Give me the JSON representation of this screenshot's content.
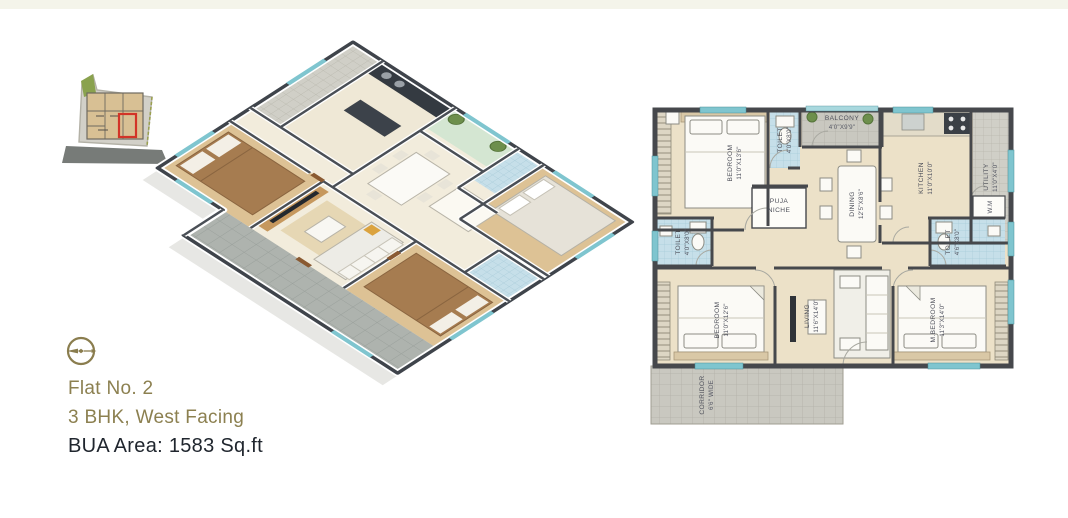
{
  "page": {
    "top_strip_color": "#f4f4ea",
    "background": "#ffffff"
  },
  "project": {
    "flat_no": "Flat No. 2",
    "configuration": "3 BHK, West Facing",
    "bua": "BUA Area: 1583 Sq.ft"
  },
  "colors": {
    "accent_olive": "#8c8050",
    "text_dark": "#20262e",
    "wall": "#46484c",
    "floor_beige": "#ece1c8",
    "tile_blue": "#c6dfe9",
    "tile_gray": "#c9c8c0",
    "wood": "#ddc295",
    "bed_brown": "#a67c50",
    "window_teal": "#7fc5cf",
    "site_highlight_red": "#d23428"
  },
  "plan2d": {
    "labels": [
      {
        "id": "bedroom-1",
        "line1": "BEDROOM",
        "line2": "11'0\"X13'6\""
      },
      {
        "id": "toilet-1",
        "line1": "TOILET",
        "line2": "4'0\"X8'0\""
      },
      {
        "id": "balcony",
        "line1": "BALCONY",
        "line2": "4'0\"X9'9\""
      },
      {
        "id": "dining",
        "line1": "DINING",
        "line2": "12'5\"X8'6\""
      },
      {
        "id": "kitchen",
        "line1": "KITCHEN",
        "line2": "11'0\"X10'0\""
      },
      {
        "id": "utility",
        "line1": "UTILITY",
        "line2": "11'0\"X4'0\""
      },
      {
        "id": "puja-niche",
        "line1": "PUJA",
        "line2": "NICHE"
      },
      {
        "id": "toilet-2",
        "line1": "TOILET",
        "line2": "4'0\"X8'0\""
      },
      {
        "id": "toilet-3",
        "line1": "TOILET",
        "line2": "4'6\"X8'0\""
      },
      {
        "id": "washing-machine",
        "line1": "W.M",
        "line2": ""
      },
      {
        "id": "bedroom-2",
        "line1": "BEDROOM",
        "line2": "11'0\"X12'6\""
      },
      {
        "id": "living",
        "line1": "LIVING",
        "line2": "11'6\"X14'0\""
      },
      {
        "id": "m-bedroom",
        "line1": "M.BEDROOM",
        "line2": "11'3\"X14'0\""
      },
      {
        "id": "corridor",
        "line1": "CORRIDOR",
        "line2": "6'6\" WIDE"
      }
    ]
  }
}
